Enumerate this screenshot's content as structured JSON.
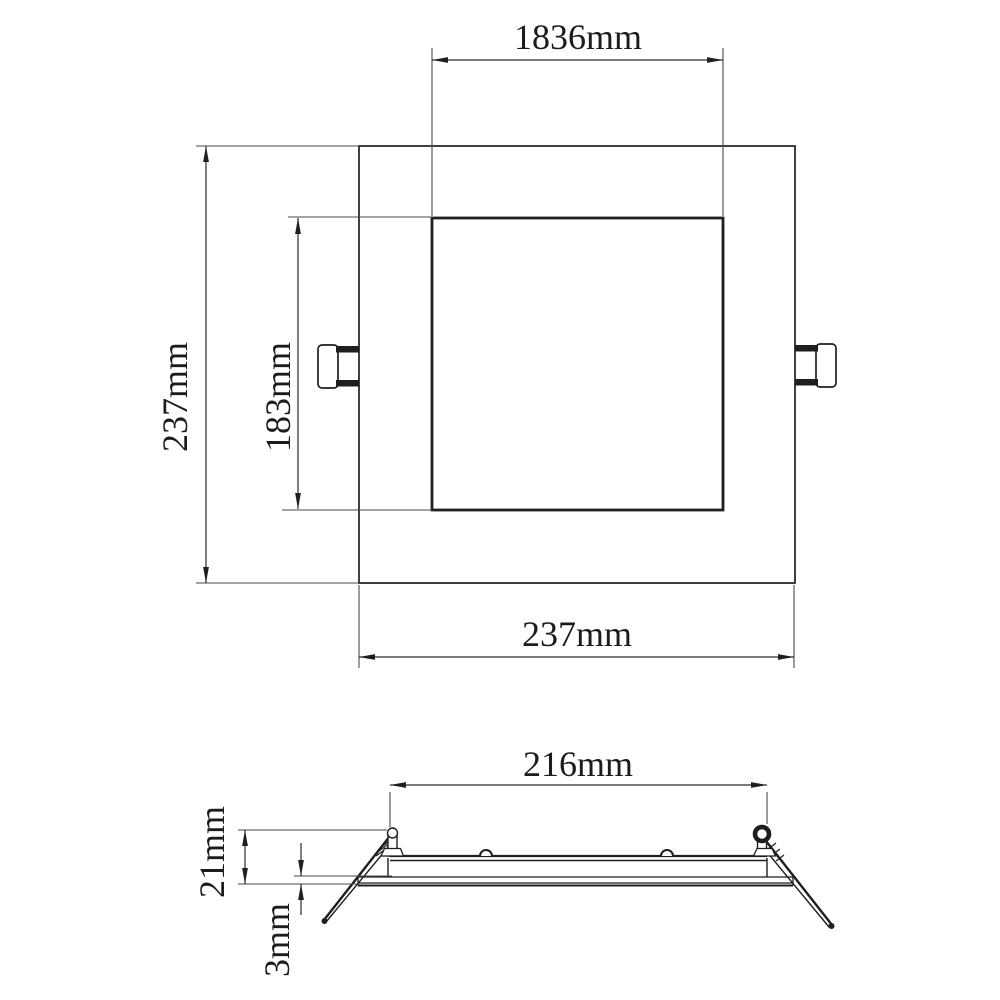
{
  "drawing": {
    "type": "technical-dimension-drawing",
    "subject": "square recessed LED panel downlight",
    "background_color": "#ffffff",
    "line_color": "#1f1f1f",
    "unit": "mm",
    "top_view": {
      "name": "front view (square panel with two side spring clips)",
      "dims": {
        "inner_width": "1836mm",
        "outer_height": "237mm",
        "inner_height": "183mm",
        "outer_width": "237mm"
      }
    },
    "side_view": {
      "name": "side profile view (slim housing with spring mounting clips)",
      "dims": {
        "cutout_width": "216mm",
        "height": "21mm",
        "thickness": "3mm"
      }
    }
  }
}
